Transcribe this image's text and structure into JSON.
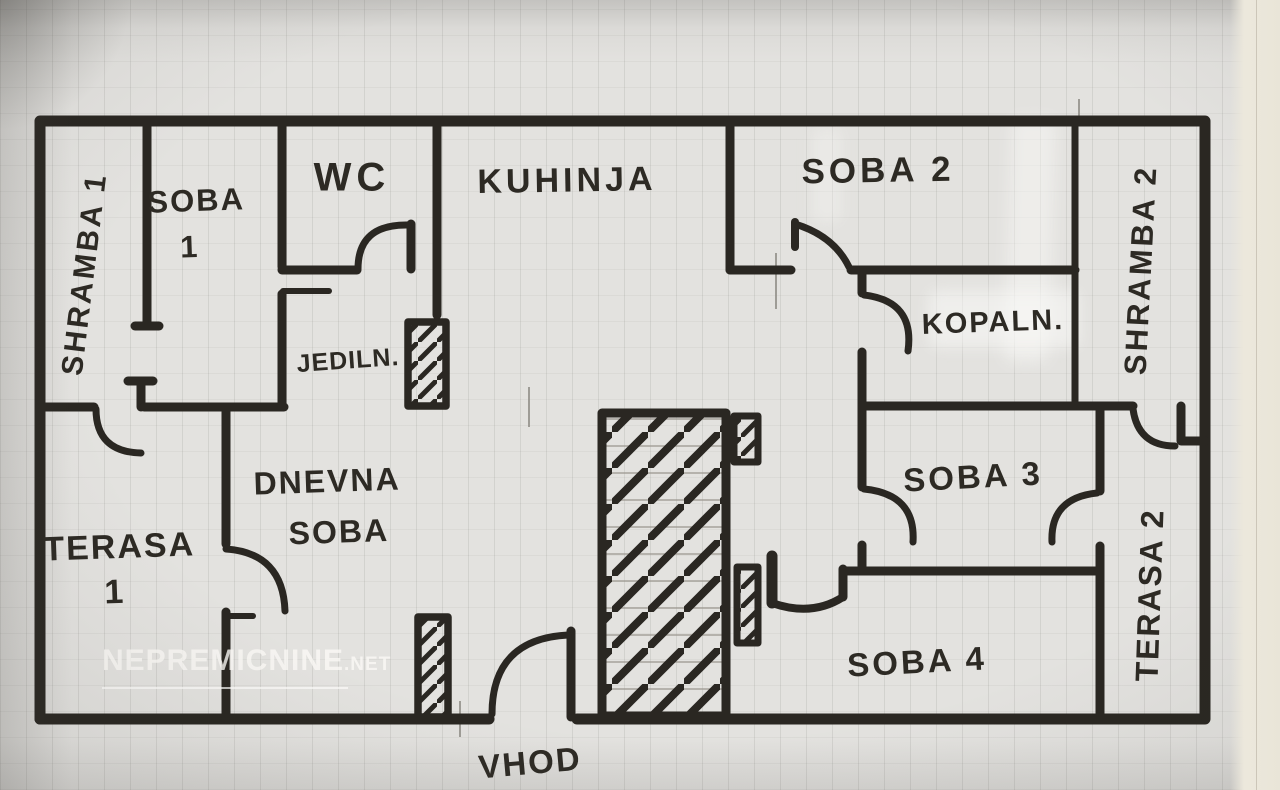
{
  "title": "Hand-drawn apartment floor plan",
  "colors": {
    "ink": "#2a2722",
    "paper": "#e3e2df",
    "watermark": "#faf9f5",
    "page_edge": "#ece8dc"
  },
  "watermark": {
    "text": "NEPREMICNINE",
    "suffix": ".NET"
  },
  "rooms": [
    {
      "id": "shramba1",
      "name": "SHRAMBA 1",
      "orientation": "vertical",
      "lines": [
        "SHRAMBA 1"
      ]
    },
    {
      "id": "soba1",
      "name": "SOBA 1",
      "orientation": "horizontal",
      "lines": [
        "SOBA",
        "1"
      ]
    },
    {
      "id": "wc",
      "name": "WC",
      "orientation": "horizontal",
      "lines": [
        "WC"
      ]
    },
    {
      "id": "kuhinja",
      "name": "KUHINJA",
      "orientation": "horizontal",
      "lines": [
        "KUHINJA"
      ]
    },
    {
      "id": "soba2",
      "name": "SOBA 2",
      "orientation": "horizontal",
      "lines": [
        "SOBA 2"
      ]
    },
    {
      "id": "shramba2",
      "name": "SHRAMBA 2",
      "orientation": "vertical",
      "lines": [
        "SHRAMBA 2"
      ]
    },
    {
      "id": "jedilnica",
      "name": "JEDILN.",
      "orientation": "horizontal",
      "lines": [
        "JEDILN."
      ]
    },
    {
      "id": "kopalnica",
      "name": "KOPALN.",
      "orientation": "horizontal",
      "lines": [
        "KOPALN."
      ]
    },
    {
      "id": "dnevna",
      "name": "DNEVNA SOBA",
      "orientation": "horizontal",
      "lines": [
        "DNEVNA",
        "SOBA"
      ]
    },
    {
      "id": "terasa1",
      "name": "TERASA 1",
      "orientation": "horizontal",
      "lines": [
        "TERASA",
        "1"
      ]
    },
    {
      "id": "soba3",
      "name": "SOBA 3",
      "orientation": "horizontal",
      "lines": [
        "SOBA 3"
      ]
    },
    {
      "id": "terasa2",
      "name": "TERASA 2",
      "orientation": "vertical",
      "lines": [
        "TERASA 2"
      ]
    },
    {
      "id": "soba4",
      "name": "SOBA 4",
      "orientation": "horizontal",
      "lines": [
        "SOBA 4"
      ]
    },
    {
      "id": "vhod",
      "name": "VHOD",
      "orientation": "horizontal",
      "lines": [
        "VHOD"
      ]
    }
  ]
}
